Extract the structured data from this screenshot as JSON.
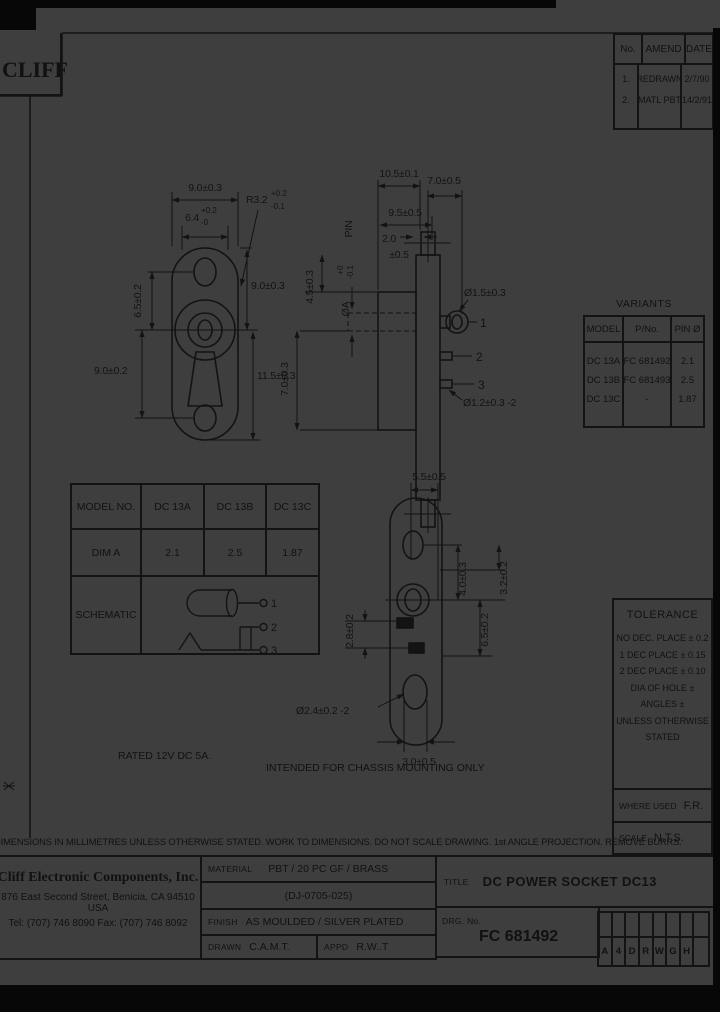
{
  "logo": {
    "text": "CLIFF"
  },
  "revision_table": {
    "headers": {
      "no": "No.",
      "amend": "AMEND",
      "date": "DATE"
    },
    "rows": [
      {
        "no": "1.",
        "amend": "REDRAWN",
        "date": "2/7/90"
      },
      {
        "no": "2.",
        "amend": "MATL PBT",
        "date": "14/2/91"
      }
    ]
  },
  "front_view": {
    "dim_width_outer": "9.0±0.3",
    "dim_width_inner": "6.4",
    "dim_width_inner_tol_plus": "+0.2",
    "dim_width_inner_tol_minus": "-0",
    "dim_radius": "R3.2",
    "dim_radius_tol_plus": "+0.2",
    "dim_radius_tol_minus": "-0.1",
    "dim_hole_pitch_upper": "6.5±0.2",
    "dim_height_upper": "9.0±0.3",
    "dim_hole_pitch_lower": "9.0±0.2",
    "dim_height_lower": "11.5±0.3"
  },
  "side_view": {
    "dim_length_total": "10.5±0.1",
    "dim_pin_length": "7.0±0.5",
    "dim_body_length": "9.5±0.5",
    "dim_flange": "2.0",
    "dim_flange_tol": "±0.5",
    "pin_label": "PIN",
    "dim_pin_dia": "ØA",
    "dim_pin_dia_tol_plus": "+0",
    "dim_pin_dia_tol_minus": "-0.1",
    "dim_height_upper": "4.5±0.3",
    "dim_height_left": "7.0±0.3",
    "dim_eyelet": "Ø1.5±0.3",
    "dim_holes": "Ø1.2±0.3 -2",
    "pins": [
      "1",
      "2",
      "3"
    ]
  },
  "bottom_view": {
    "dim_width_top": "5.5±0.5",
    "dim_right_outer": "3.2±0.2",
    "dim_right_mid": "6.5±0.2",
    "dim_right_inner": "4.0±0.3",
    "dim_left": "2.8±0.2",
    "dim_holes": "Ø2.4±0.2 -2",
    "dim_width_bottom": "3.0±0.5"
  },
  "variants_table": {
    "title": "VARIANTS",
    "headers": {
      "model": "MODEL",
      "pno": "P/No.",
      "pin": "PIN Ø"
    },
    "rows": [
      {
        "model": "DC 13A",
        "pno": "FC 681492",
        "pin": "2.1"
      },
      {
        "model": "DC 13B",
        "pno": "FC 681493",
        "pin": "2.5"
      },
      {
        "model": "DC 13C",
        "pno": "-",
        "pin": "1.87"
      }
    ]
  },
  "model_table": {
    "header": {
      "label": "MODEL NO.",
      "a": "DC 13A",
      "b": "DC 13B",
      "c": "DC 13C"
    },
    "dim_row": {
      "label": "DIM A",
      "a": "2.1",
      "b": "2.5",
      "c": "1.87"
    },
    "schematic_label": "SCHEMATIC",
    "schematic_pins": [
      "1",
      "2",
      "3"
    ]
  },
  "tolerance_box": {
    "title": "TOLERANCE",
    "lines": [
      "NO DEC. PLACE ± 0.2",
      "1 DEC PLACE ± 0.15",
      "2 DEC PLACE ± 0.10",
      "DIA OF HOLE ±",
      "ANGLES ±",
      "UNLESS OTHERWISE",
      "STATED"
    ],
    "where_used_label": "WHERE USED",
    "where_used_value": "F.R.",
    "scale_label": "SCALE",
    "scale_value": "N.T.S."
  },
  "notes": {
    "rated": "RATED 12V DC 5A.",
    "mounting": "INTENDED FOR CHASSIS MOUNTING ONLY",
    "footer": "DIMENSIONS IN MILLIMETRES UNLESS OTHERWISE STATED.  WORK TO DIMENSIONS.  DO NOT SCALE DRAWING.  1st ANGLE PROJECTION.  REMOVE BURRS."
  },
  "title_block": {
    "company_name": "Cliff Electronic Components, Inc.",
    "company_address": "876 East Second Street, Benicia, CA 94510 USA",
    "company_phone": "Tel: (707) 746 8090  Fax: (707) 746 8092",
    "material_label": "MATERIAL",
    "material_value": "PBT / 20 PC GF / BRASS",
    "material_code": "(DJ-0705-025)",
    "finish_label": "FINISH",
    "finish_value": "AS MOULDED / SILVER PLATED",
    "drawn_label": "DRAWN",
    "drawn_value": "C.A.M.T.",
    "appd_label": "APPD",
    "appd_value": "R.W..T",
    "title_label": "TITLE",
    "title_value": "DC POWER SOCKET DC13",
    "drg_label": "DRG. No.",
    "drg_value": "FC 681492",
    "grid_letters": [
      "A",
      "4",
      "D",
      "R",
      "W",
      "G",
      "H"
    ]
  }
}
